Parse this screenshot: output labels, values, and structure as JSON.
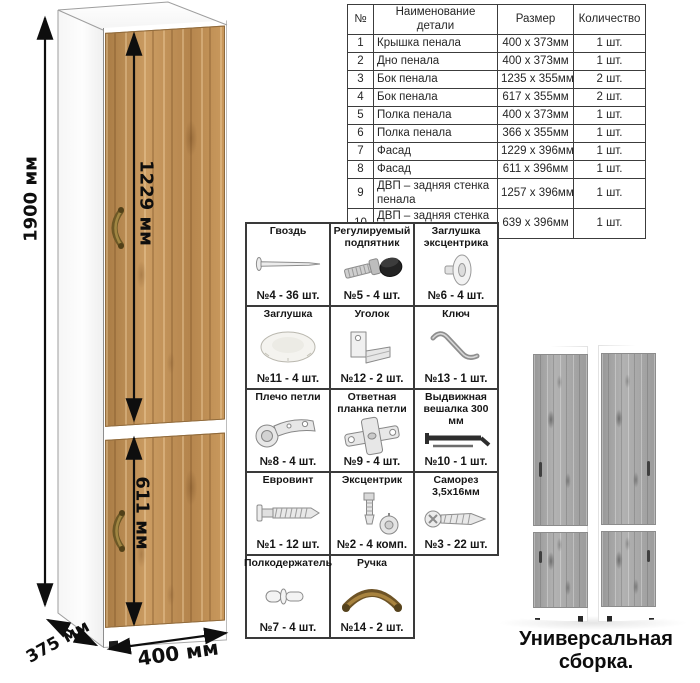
{
  "parts_table": {
    "headers": [
      "№",
      "Наименование детали",
      "Размер",
      "Количество"
    ],
    "rows": [
      {
        "num": "1",
        "name": "Крышка пенала",
        "size": "400 х 373мм",
        "qty": "1 шт."
      },
      {
        "num": "2",
        "name": "Дно пенала",
        "size": "400 х 373мм",
        "qty": "1 шт."
      },
      {
        "num": "3",
        "name": "Бок пенала",
        "size": "1235 х 355мм",
        "qty": "2 шт."
      },
      {
        "num": "4",
        "name": "Бок пенала",
        "size": "617 х 355мм",
        "qty": "2 шт."
      },
      {
        "num": "5",
        "name": "Полка пенала",
        "size": "400 х 373мм",
        "qty": "1 шт."
      },
      {
        "num": "6",
        "name": "Полка пенала",
        "size": "366 х 355мм",
        "qty": "1 шт."
      },
      {
        "num": "7",
        "name": "Фасад",
        "size": "1229 х 396мм",
        "qty": "1 шт."
      },
      {
        "num": "8",
        "name": "Фасад",
        "size": "611 х 396мм",
        "qty": "1 шт."
      },
      {
        "num": "9",
        "name": "ДВП – задняя стенка пенала",
        "size": "1257 х 396мм",
        "qty": "1 шт."
      },
      {
        "num": "10",
        "name": "ДВП – задняя стенка пенала",
        "size": "639 х 396мм",
        "qty": "1 шт."
      }
    ]
  },
  "hardware": {
    "items": [
      {
        "name": "Гвоздь",
        "count": "№4 - 36 шт.",
        "icon": "nail-icon"
      },
      {
        "name": "Регулируемый подпятник",
        "count": "№5 - 4 шт.",
        "icon": "adjustable-foot-icon"
      },
      {
        "name": "Заглушка эксцентрика",
        "count": "№6 - 4 шт.",
        "icon": "cam-cover-icon"
      },
      {
        "name": "Заглушка",
        "count": "№11 - 4 шт.",
        "icon": "cover-cap-icon"
      },
      {
        "name": "Уголок",
        "count": "№12 - 2 шт.",
        "icon": "corner-bracket-icon"
      },
      {
        "name": "Ключ",
        "count": "№13 - 1 шт.",
        "icon": "key-icon"
      },
      {
        "name": "Плечо петли",
        "count": "№8 - 4 шт.",
        "icon": "hinge-arm-icon"
      },
      {
        "name": "Ответная планка петли",
        "count": "№9 - 4 шт.",
        "icon": "hinge-plate-icon"
      },
      {
        "name": "Выдвижная вешалка 300 мм",
        "count": "№10 - 1 шт.",
        "icon": "hanger-rod-icon"
      },
      {
        "name": "Евровинт",
        "count": "№1 - 12 шт.",
        "icon": "euroscrew-icon"
      },
      {
        "name": "Эксцентрик",
        "count": "№2 - 4 комп.",
        "icon": "cam-lock-icon"
      },
      {
        "name": "Саморез 3,5х16мм",
        "count": "№3 - 22 шт.",
        "icon": "screw-icon"
      },
      {
        "name": "Полкодержатель",
        "count": "№7 - 4 шт.",
        "icon": "shelf-pin-icon"
      },
      {
        "name": "Ручка",
        "count": "№14 - 2 шт.",
        "icon": "handle-icon"
      }
    ]
  },
  "dimensions": {
    "height": "1900 мм",
    "upper_door": "1229 мм",
    "lower_door": "611 мм",
    "depth": "375 мм",
    "width": "400 мм"
  },
  "caption": "Универсальная сборка.",
  "colors": {
    "wood_base": "#bd8c52",
    "wood_dark": "#8f6233",
    "wood_light": "#cfa266",
    "gray_wood": "#a5a5a5",
    "line_dark": "#3a3a3a",
    "handle_bronze": "#8a6d36"
  }
}
